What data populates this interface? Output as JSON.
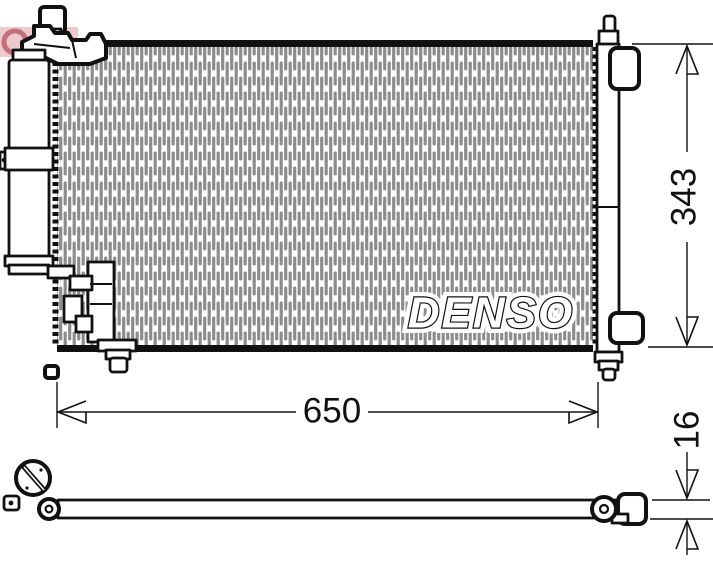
{
  "drawing": {
    "brand_watermark": "DENSO",
    "dimensions": {
      "width": "650",
      "height": "343",
      "depth": "16"
    },
    "colors": {
      "line_black": "#111111",
      "fin_gray": "#8c8c8c",
      "watermark_pink": "#eec9cd",
      "watermark_red": "#c4707a",
      "background": "#ffffff"
    }
  }
}
